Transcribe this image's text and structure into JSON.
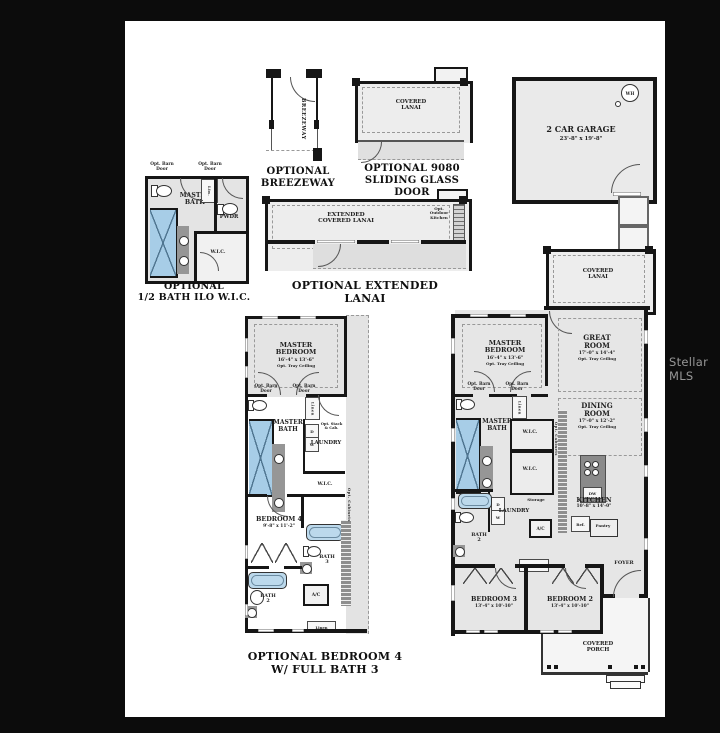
{
  "watermark": "Stellar MLS",
  "colors": {
    "background": "#0c0c0c",
    "sheet": "#ffffff",
    "wall": "#161616",
    "room_fill": "#e6e6e6",
    "water_fixture_blue": "#a7cde7",
    "counter_gray": "#969696"
  },
  "captions": {
    "half_bath": "OPTIONAL\n1/2 BATH ILO W.I.C.",
    "breezeway": "OPTIONAL\nBREEZEWAY",
    "sliding_glass_door": "OPTIONAL 9080\nSLIDING GLASS DOOR\nAT GREAT ROOM",
    "extended_lanai": "OPTIONAL EXTENDED LANAI",
    "bedroom4": "OPTIONAL BEDROOM 4\nW/ FULL BATH 3"
  },
  "half_bath": {
    "barn_door_left": "Opt. Barn\nDoor",
    "barn_door_right": "Opt. Barn\nDoor",
    "master_bath": "MASTER\nBATH",
    "linen": "Lin.",
    "pwdr": "PWDR",
    "wic": "W.I.C."
  },
  "breezeway": {
    "label": "BREEZEWAY"
  },
  "sliding_glass_door": {
    "covered_lanai": "COVERED\nLANAI"
  },
  "garage": {
    "name": "2 CAR GARAGE",
    "dims": "23'-8\" x 19'-8\"",
    "water_heater": "WH"
  },
  "extended_lanai": {
    "label": "EXTENDED\nCOVERED LANAI",
    "outdoor_kitchen": "Opt.\nOutdoor\nKitchen"
  },
  "bedroom4_plan": {
    "master_bedroom": "MASTER\nBEDROOM",
    "master_bedroom_dims": "16'-4\" x 13'-6\"",
    "master_bedroom_tray": "Opt. Tray Ceiling",
    "barn_door_left": "Opt. Barn\nDoor",
    "barn_door_right": "Opt. Barn\nDoor",
    "master_bath": "MASTER\nBATH",
    "linen_cabinet": "Linen",
    "opt_stack": "Opt. Stack\n& Cab.",
    "laundry": "LAUNDRY",
    "dryer": "D",
    "washer": "W",
    "wic": "W.I.C.",
    "opt_cabinets": "Opt. Cabinets",
    "bedroom4": "BEDROOM 4",
    "bedroom4_dims": "9'-8\" x 11'-2\"",
    "bath3": "BATH\n3",
    "bath2": "BATH\n2",
    "ac": "A/C",
    "linen": "Linen"
  },
  "main_plan": {
    "covered_lanai": "COVERED\nLANAI",
    "great_room": "GREAT\nROOM",
    "great_room_dims": "17'-0\" x 14'-4\"",
    "great_room_tray": "Opt. Tray Ceiling",
    "master_bedroom": "MASTER\nBEDROOM",
    "master_bedroom_dims": "16'-4\" x 13'-6\"",
    "master_bedroom_tray": "Opt. Tray Ceiling",
    "dining_room": "DINING\nROOM",
    "dining_room_dims": "17'-0\" x 12'-2\"",
    "dining_room_tray": "Opt. Tray Ceiling",
    "barn_door_left": "Opt. Barn\nDoor",
    "barn_door_right": "Opt. Barn\nDoor",
    "master_bath": "MASTER\nBATH",
    "linen_cabinet": "Linen",
    "wic1": "W.I.C.",
    "wic2": "W.I.C.",
    "opt_cabinets": "Opt. Cabinets",
    "storage": "Storage",
    "laundry": "LAUNDRY",
    "dryer": "D",
    "washer": "W",
    "ac": "A/C",
    "bath2": "BATH\n2",
    "kitchen": "KITCHEN",
    "kitchen_dims": "10'-8\" x 14'-0\"",
    "ref": "Ref.",
    "pantry": "Pantry",
    "dishwasher": "DW",
    "linen": "Linen",
    "foyer": "FOYER",
    "bedroom3": "BEDROOM 3",
    "bedroom3_dims": "13'-4\" x 10'-10\"",
    "bedroom2": "BEDROOM 2",
    "bedroom2_dims": "13'-4\" x 10'-10\"",
    "covered_porch": "COVERED\nPORCH"
  }
}
